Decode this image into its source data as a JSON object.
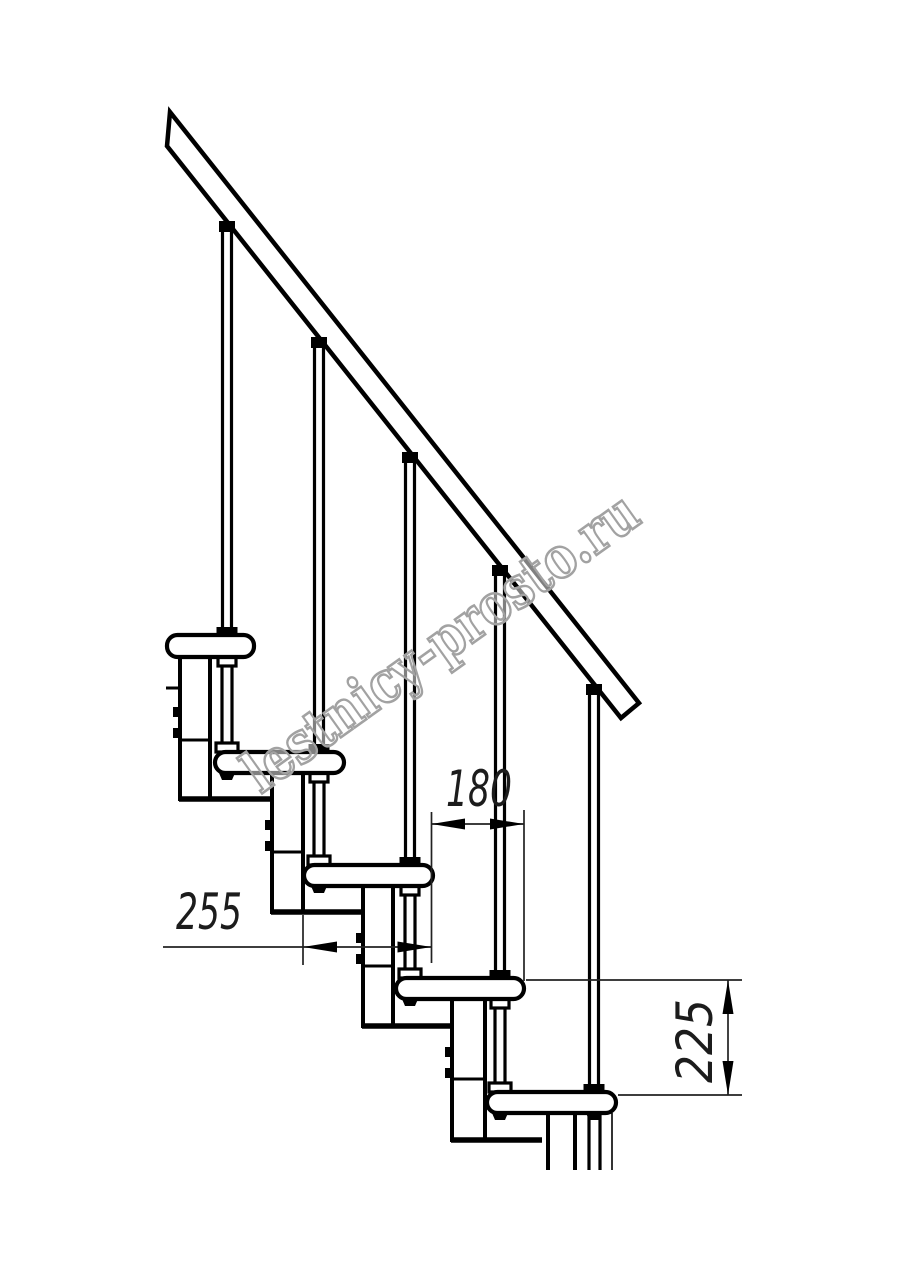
{
  "drawing": {
    "type": "technical-drawing",
    "subject": "modular staircase side-view fragment with handrail, five treads and balusters",
    "units_implied": "mm",
    "dimensions": {
      "tread_depth": {
        "label": "255",
        "orientation": "horizontal"
      },
      "step_pitch": {
        "label": "180",
        "orientation": "horizontal"
      },
      "riser_height": {
        "label": "225",
        "orientation": "vertical"
      }
    },
    "counts": {
      "treads_visible": 5,
      "balusters_visible": 5,
      "support_modules_visible": 4
    },
    "colors": {
      "background": "#ffffff",
      "line": "#000000",
      "dim_line": "#222222",
      "watermark_outline": "#a2a2a2",
      "watermark_fill": "#ffffff"
    }
  },
  "watermark": {
    "text": "lestnicy-prosto.ru"
  }
}
